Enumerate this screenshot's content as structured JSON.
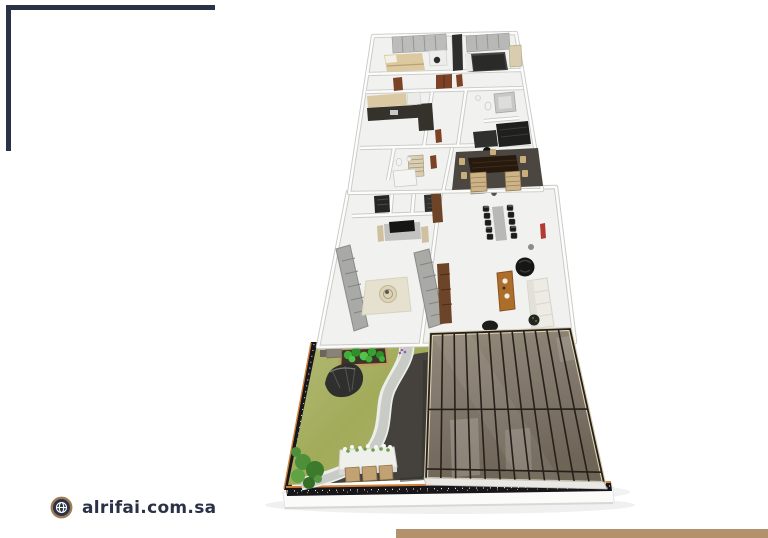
{
  "page": {
    "width": 768,
    "height": 538,
    "background": "#ffffff"
  },
  "frame": {
    "corner_color": "#2b3147",
    "bottom_bar_color": "#b3916c"
  },
  "footer": {
    "website": "alrifai.com.sa",
    "text_color": "#2b3247",
    "icon": {
      "name": "globe-icon",
      "ring_color": "#9c7b52",
      "fill_color": "#2b3247",
      "line_color": "#ffffff"
    }
  },
  "scene": {
    "description": "isometric 3D floor plan rendering with garden and pergola",
    "colors": {
      "floor": "#f1f1f0",
      "wall_gray": "#c9c9c7",
      "wall_white": "#fcfcfb",
      "lawn": "#a2ab59",
      "lawn_light": "#c2c790",
      "paving_charcoal": "#45423d",
      "path_gray": "#c9cbc6",
      "path_curb": "#eceeea",
      "trim_dark": "#17171b",
      "trim_orange": "#d4813b",
      "platform_white": "#fbfbfa",
      "pergola_frame_light": "#d9cfb4",
      "pergola_grid": "#262019",
      "wood_door": "#7c4226",
      "wood_cabinet": "#6d4427",
      "wood_table": "#ad6e2c",
      "bed_beige": "#dcc9a0",
      "rug_beige": "#e6e0cf",
      "sofa_gray": "#a9a9a6",
      "sofa_white": "#edebe4",
      "furniture_dark": "#232322",
      "counter_dark": "#35312b",
      "shrub_green": "#3fae3a",
      "bush_green": "#4e8f3a",
      "planter_wood": "#bf9b60",
      "paver_tan": "#c2a173",
      "red_accent": "#b23a30",
      "conference_rug": "#4b463f",
      "mat_tan": "#cdb488"
    }
  }
}
